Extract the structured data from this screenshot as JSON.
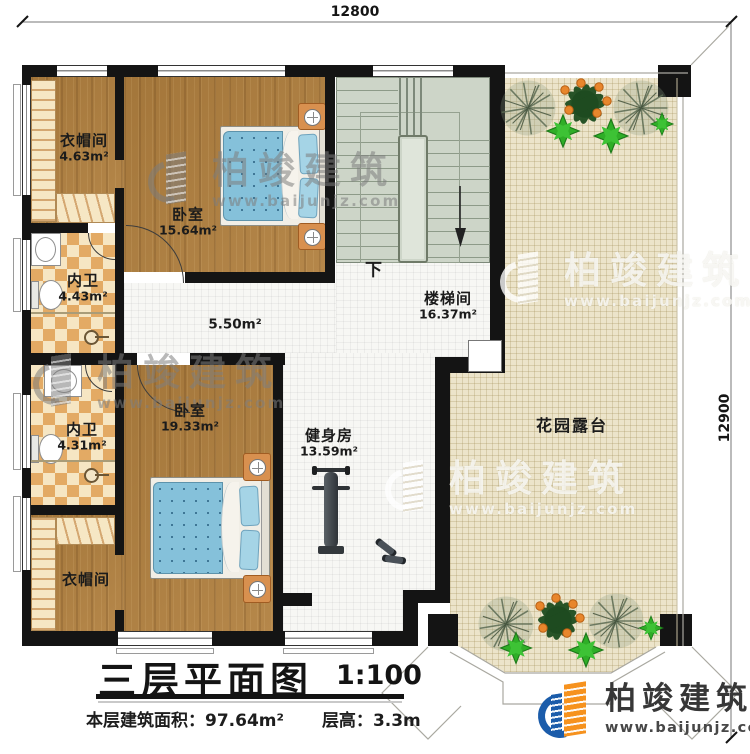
{
  "dimensions": {
    "top": "12800",
    "right": "12900"
  },
  "rooms": {
    "cloakroom_upper": {
      "name": "衣帽间",
      "area": "4.63m²"
    },
    "bedroom_upper": {
      "name": "卧室",
      "area": "15.64m²"
    },
    "bath_upper": {
      "name": "内卫",
      "area": "4.43m²"
    },
    "bath_lower": {
      "name": "内卫",
      "area": "4.31m²"
    },
    "cloakroom_lower": {
      "name": "衣帽间"
    },
    "bedroom_lower": {
      "name": "卧室",
      "area": "19.33m²"
    },
    "hallway": {
      "area": "5.50m²"
    },
    "stairwell": {
      "name": "楼梯间",
      "area": "16.37m²",
      "down": "下"
    },
    "gym": {
      "name": "健身房",
      "area": "13.59m²"
    },
    "terrace": {
      "name": "花园露台"
    }
  },
  "title_block": {
    "title": "三层平面图",
    "scale": "1:100",
    "area_label": "本层建筑面积：",
    "area_value": "97.64m²",
    "height_label": "层高：",
    "height_value": "3.3m"
  },
  "branding": {
    "company": "柏竣建筑",
    "website": "www.baijunjz.com"
  },
  "colors": {
    "wall": "#141414",
    "wood": "#b1803f",
    "tile": "#e3aa64",
    "stairs": "#cdd5c8",
    "terrace": "#ece4ca",
    "bed": "#85c1da",
    "logo_orange": "#f6921e",
    "logo_blue": "#1b5caa"
  }
}
